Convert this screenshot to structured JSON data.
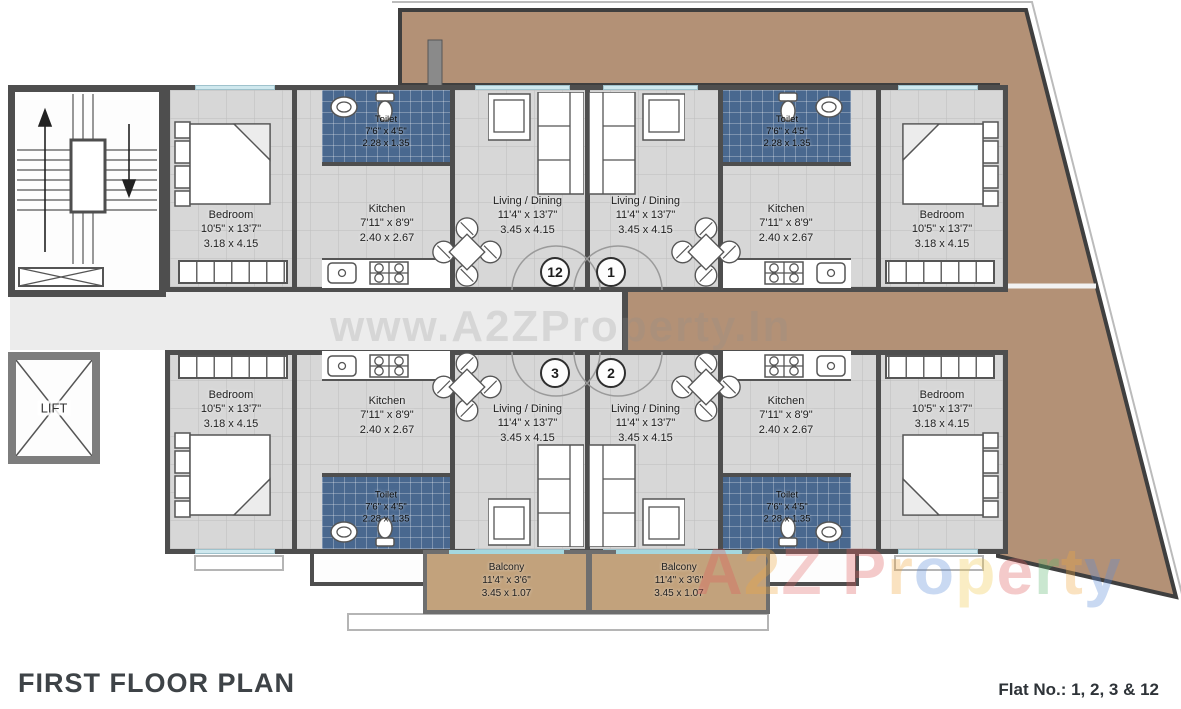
{
  "title": "FIRST FLOOR PLAN",
  "flat_note": "Flat No.: 1, 2, 3 & 12",
  "lift_label": "LIFT",
  "watermark": {
    "center": "www.A2ZProperty.In",
    "brand": "A2Z Property",
    "brand_colors": [
      "#e05c5c",
      "#f0a73f",
      "#e36a6a",
      "#888888",
      "#e05c5c",
      "#f0a73f",
      "#5b8bd9",
      "#f2c94c",
      "#e05c5c",
      "#5cb870",
      "#f0a73f",
      "#5b8bd9"
    ]
  },
  "units": [
    {
      "number": "12",
      "rooms": {
        "bedroom": {
          "name": "Bedroom",
          "ft": "10'5\" x 13'7\"",
          "m": "3.18 x 4.15"
        },
        "kitchen": {
          "name": "Kitchen",
          "ft": "7'11\" x 8'9\"",
          "m": "2.40 x 2.67"
        },
        "toilet": {
          "name": "Toilet",
          "ft": "7'6\" x 4'5\"",
          "m": "2.28 x 1.35"
        },
        "living": {
          "name": "Living / Dining",
          "ft": "11'4\" x 13'7\"",
          "m": "3.45 x 4.15"
        }
      }
    },
    {
      "number": "1",
      "rooms": {
        "bedroom": {
          "name": "Bedroom",
          "ft": "10'5\" x 13'7\"",
          "m": "3.18 x 4.15"
        },
        "kitchen": {
          "name": "Kitchen",
          "ft": "7'11\" x 8'9\"",
          "m": "2.40 x 2.67"
        },
        "toilet": {
          "name": "Toilet",
          "ft": "7'6\" x 4'5\"",
          "m": "2.28 x 1.35"
        },
        "living": {
          "name": "Living / Dining",
          "ft": "11'4\" x 13'7\"",
          "m": "3.45 x 4.15"
        }
      }
    },
    {
      "number": "3",
      "rooms": {
        "bedroom": {
          "name": "Bedroom",
          "ft": "10'5\" x 13'7\"",
          "m": "3.18 x 4.15"
        },
        "kitchen": {
          "name": "Kitchen",
          "ft": "7'11\" x 8'9\"",
          "m": "2.40 x 2.67"
        },
        "toilet": {
          "name": "Toilet",
          "ft": "7'6\" x 4'5\"",
          "m": "2.28 x 1.35"
        },
        "living": {
          "name": "Living / Dining",
          "ft": "11'4\" x 13'7\"",
          "m": "3.45 x 4.15"
        }
      }
    },
    {
      "number": "2",
      "rooms": {
        "bedroom": {
          "name": "Bedroom",
          "ft": "10'5\" x 13'7\"",
          "m": "3.18 x 4.15"
        },
        "kitchen": {
          "name": "Kitchen",
          "ft": "7'11\" x 8'9\"",
          "m": "2.40 x 2.67"
        },
        "toilet": {
          "name": "Toilet",
          "ft": "7'6\" x 4'5\"",
          "m": "2.28 x 1.35"
        },
        "living": {
          "name": "Living / Dining",
          "ft": "11'4\" x 13'7\"",
          "m": "3.45 x 4.15"
        }
      }
    }
  ],
  "balconies": [
    {
      "name": "Balcony",
      "ft": "11'4\" x 3'6\"",
      "m": "3.45 x 1.07"
    },
    {
      "name": "Balcony",
      "ft": "11'4\" x 3'6\"",
      "m": "3.45 x 1.07"
    }
  ],
  "colors": {
    "wall": "#4e4e4e",
    "floor": "#d7d7d7",
    "corridor": "#ececec",
    "terrace": "#b39176",
    "balcony_floor": "#c2a27c",
    "toilet_tile": "#49688f",
    "window": "#cfe8ee"
  }
}
